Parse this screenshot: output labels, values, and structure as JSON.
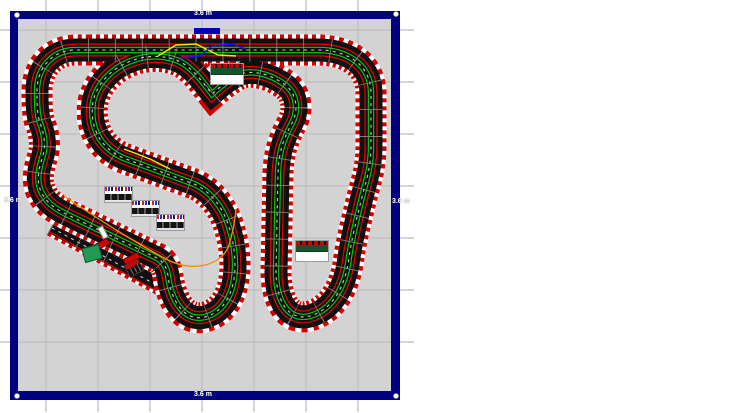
{
  "app": {
    "name": "slot-car track plan canvas",
    "description": "Track design layout sheet"
  },
  "board": {
    "page_bg": "#ffffff",
    "canvas_bg": "#d3d3d3",
    "frame_color": "#000080",
    "grid_color": "#aaaaaa",
    "dimension_labels": [
      {
        "id": "top",
        "text": "3.6 m",
        "x": 190,
        "y": 10
      },
      {
        "id": "bottom",
        "text": "3.6 m",
        "x": 190,
        "y": 391
      },
      {
        "id": "left",
        "text": "3.6 m",
        "x": 0,
        "y": 197
      },
      {
        "id": "right",
        "text": "3.6 m",
        "x": 388,
        "y": 198
      }
    ]
  },
  "colors": {
    "curb-red": "#d40000",
    "track": "#101010",
    "lane-red": "#e80000",
    "lane-green": "#00d000",
    "race-yellow": "#ffe400",
    "race-blue": "#1414ff",
    "race-orange": "#ff8c00",
    "marker-blue": "#0000b4"
  },
  "scenery": {
    "grandstands_small": [
      {
        "x": 104,
        "y": 186,
        "rot": 0
      },
      {
        "x": 131,
        "y": 200,
        "rot": 0
      },
      {
        "x": 156,
        "y": 214,
        "rot": 0
      }
    ],
    "grandstands_large": [
      {
        "x": 210,
        "y": 63,
        "rot": 0
      },
      {
        "x": 295,
        "y": 240,
        "rot": 0
      }
    ]
  },
  "track_items": [
    {
      "type": "sline",
      "name": "start-line",
      "x": 100,
      "y": 226,
      "rot": -28
    },
    {
      "type": "car",
      "name": "car-red-1",
      "x": 93,
      "y": 241,
      "rot": -28
    },
    {
      "type": "car",
      "name": "car-red-2",
      "x": 123,
      "y": 255,
      "rot": -28
    },
    {
      "type": "gbox",
      "name": "green-building",
      "x": 83,
      "y": 246,
      "rot": -15
    },
    {
      "type": "pbox",
      "name": "power-base-unit",
      "x": 126,
      "y": 261,
      "rot": -28
    }
  ]
}
